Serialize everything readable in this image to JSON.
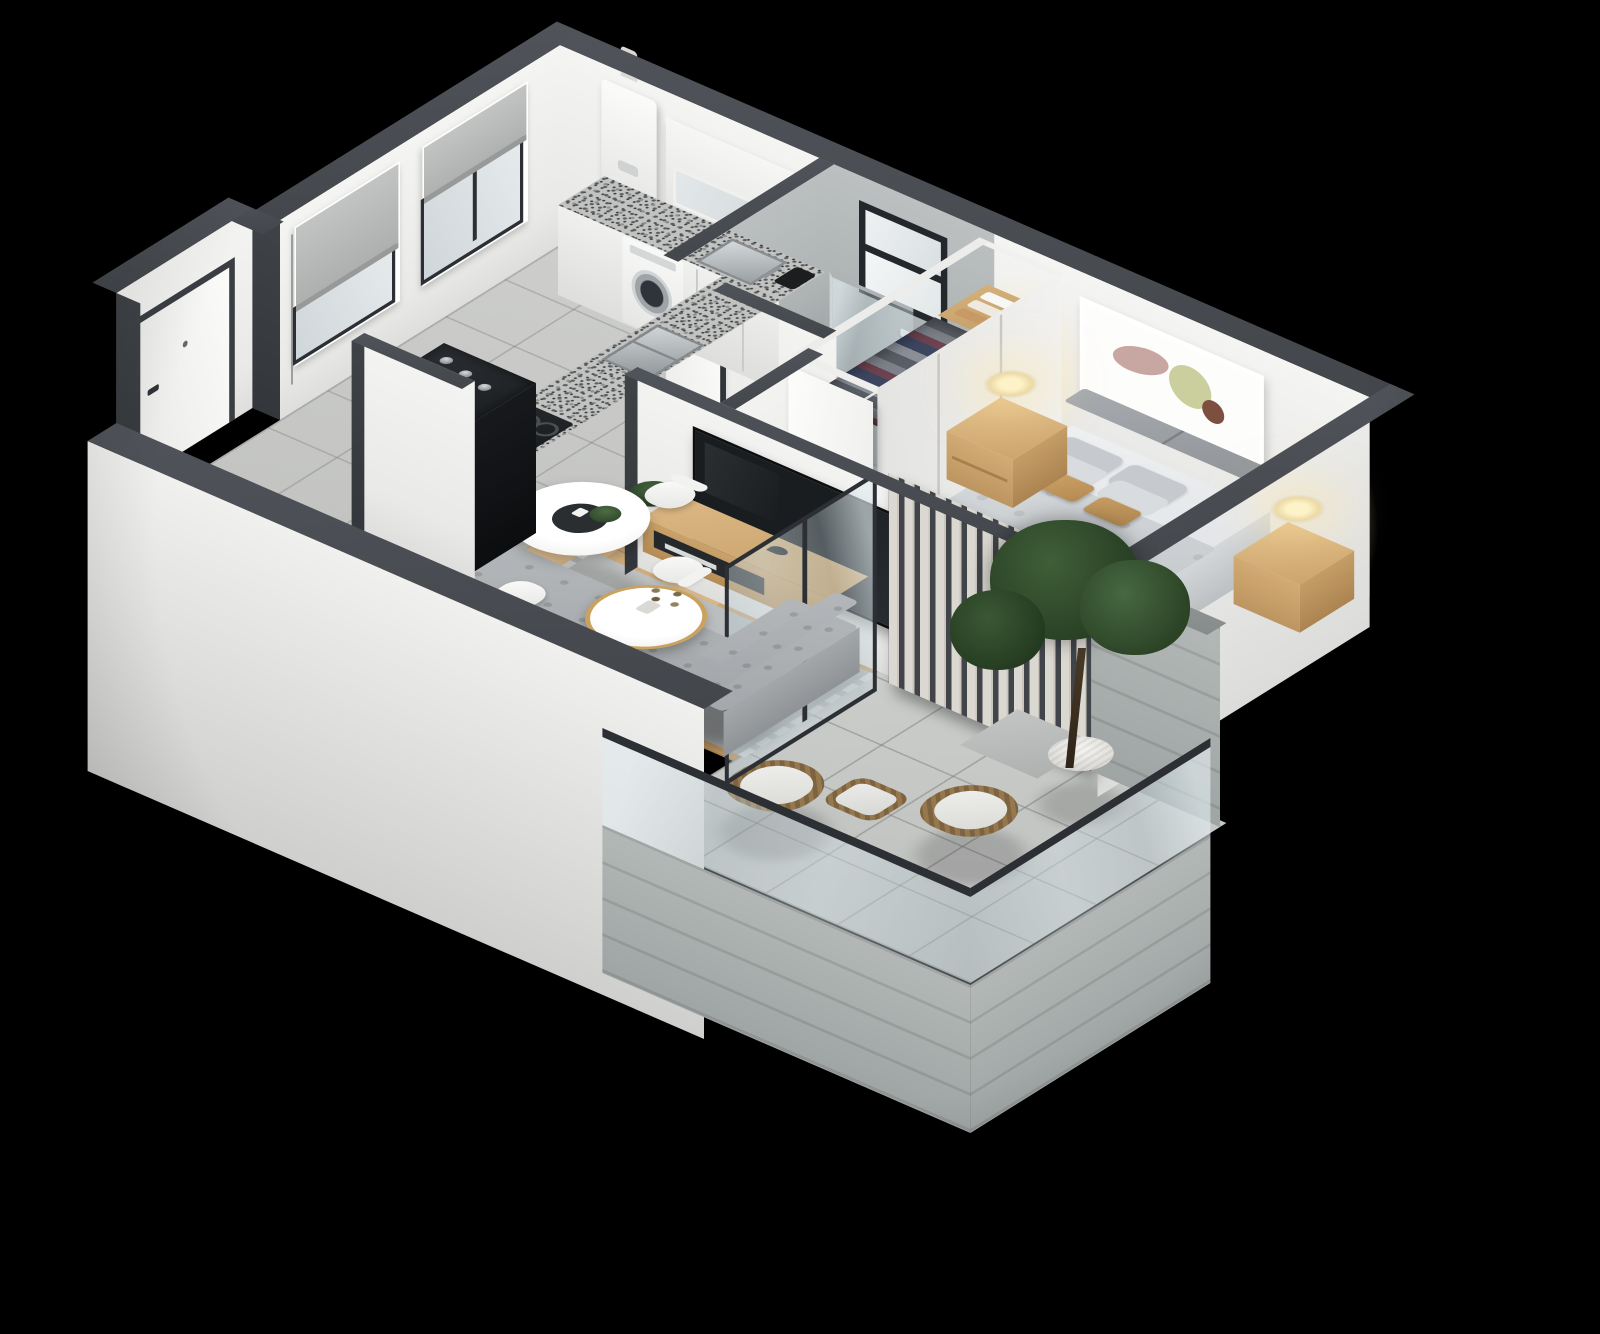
{
  "meta": {
    "kind": "3d-isometric-floor-plan-render",
    "background_color": "#000000",
    "view": "axonometric top-down from south-west",
    "visible_text": "none"
  },
  "palette": {
    "wall_top_charcoal": "#45494e",
    "wall_face_white": "#f2f2f0",
    "concrete_gray": "#b4b8b9",
    "wood_floor_oak": "#d3ab77",
    "ceramic_tile_gray": "#c7c8c6",
    "balcony_tile_gray": "#c3c5c3",
    "furniture_wood": "#d6b27e",
    "upholstery_gray": "#a8adb0",
    "bedding_gray": "#cfd3d6",
    "accent_tan": "#c59a66",
    "glass_tint": "#cdd7da",
    "foliage_green": "#33502f",
    "lamp_glow_warm": "#f7e7b8",
    "fixture_black": "#141619"
  },
  "rooms": [
    {
      "id": "kitchen",
      "name": "kitchen",
      "floor": "gray ceramic tile",
      "position": "top-left"
    },
    {
      "id": "entry",
      "name": "entry hall",
      "floor": "gray ceramic tile",
      "position": "left"
    },
    {
      "id": "bathroom",
      "name": "bathroom",
      "floor": "concrete tile",
      "position": "top-center"
    },
    {
      "id": "wardrobe",
      "name": "walk-in wardrobe",
      "floor": "wood",
      "position": "center"
    },
    {
      "id": "bedroom",
      "name": "bedroom",
      "floor": "oak wood planks",
      "position": "right"
    },
    {
      "id": "living",
      "name": "living-dining room",
      "floor": "oak wood planks",
      "position": "bottom-center"
    },
    {
      "id": "balcony",
      "name": "balcony terrace",
      "floor": "large concrete tile",
      "position": "bottom-right"
    }
  ],
  "furniture_and_fixtures": {
    "kitchen": [
      "two windows with gray roller shades",
      "wall-mounted gas water heater with flue",
      "upper cabinet with frosted glass",
      "speckled granite countertop",
      "front-load washing machine",
      "stainless inset sink",
      "black coffee maker",
      "double-bowl stainless sink on return counter",
      "4-burner gas stove",
      "black bottle cabinet with bottles",
      "white base cabinets"
    ],
    "entry": [
      "white entrance door with dark frame and handle"
    ],
    "bathroom": [
      "black-framed window",
      "walk-in shower with concrete walls and glass screen",
      "soap dish",
      "toilet-paper holder",
      "white bidet",
      "white toilet",
      "round vessel sink on wood vanity"
    ],
    "wardrobe": [
      "open closet rail with hanging clothes",
      "white sliding doors",
      "wood shelf with folded white and tan towels"
    ],
    "bedroom": [
      "double bed with gray upholstered headboard",
      "gray quilted duvet and knit throw",
      "gray pillows and two tan accent pillows",
      "two light-wood nightstands",
      "two lit drum-shade table lamps",
      "abstract framed artwork",
      "white open door"
    ],
    "living": [
      "round white dining table",
      "black tray with green plant and cup",
      "four white shell chairs with wood legs",
      "gray L-shaped tufted sofa",
      "gray area rug with fringe",
      "round white coffee table with brass edge and dried-flower vase",
      "wall-mounted flat TV",
      "floating wood media console with magazines",
      "black bird figurine",
      "small potted plant on white cube"
    ],
    "balcony": [
      "white vertical-slat privacy screen",
      "green tree in white ribbed pot",
      "sliding glass doors with dark frames",
      "glass balustrade with dark rail",
      "concrete plank-clad parapet",
      "two rattan lounge chairs with white cushions",
      "rattan ottoman with white cushion",
      "step down from bedroom"
    ]
  },
  "structure": {
    "wall_cut_style": "camera-side south walls cut low, far walls full height",
    "wall_tops": "dark charcoal bands",
    "exterior_faces": "tall white slabs descending below floor line"
  }
}
